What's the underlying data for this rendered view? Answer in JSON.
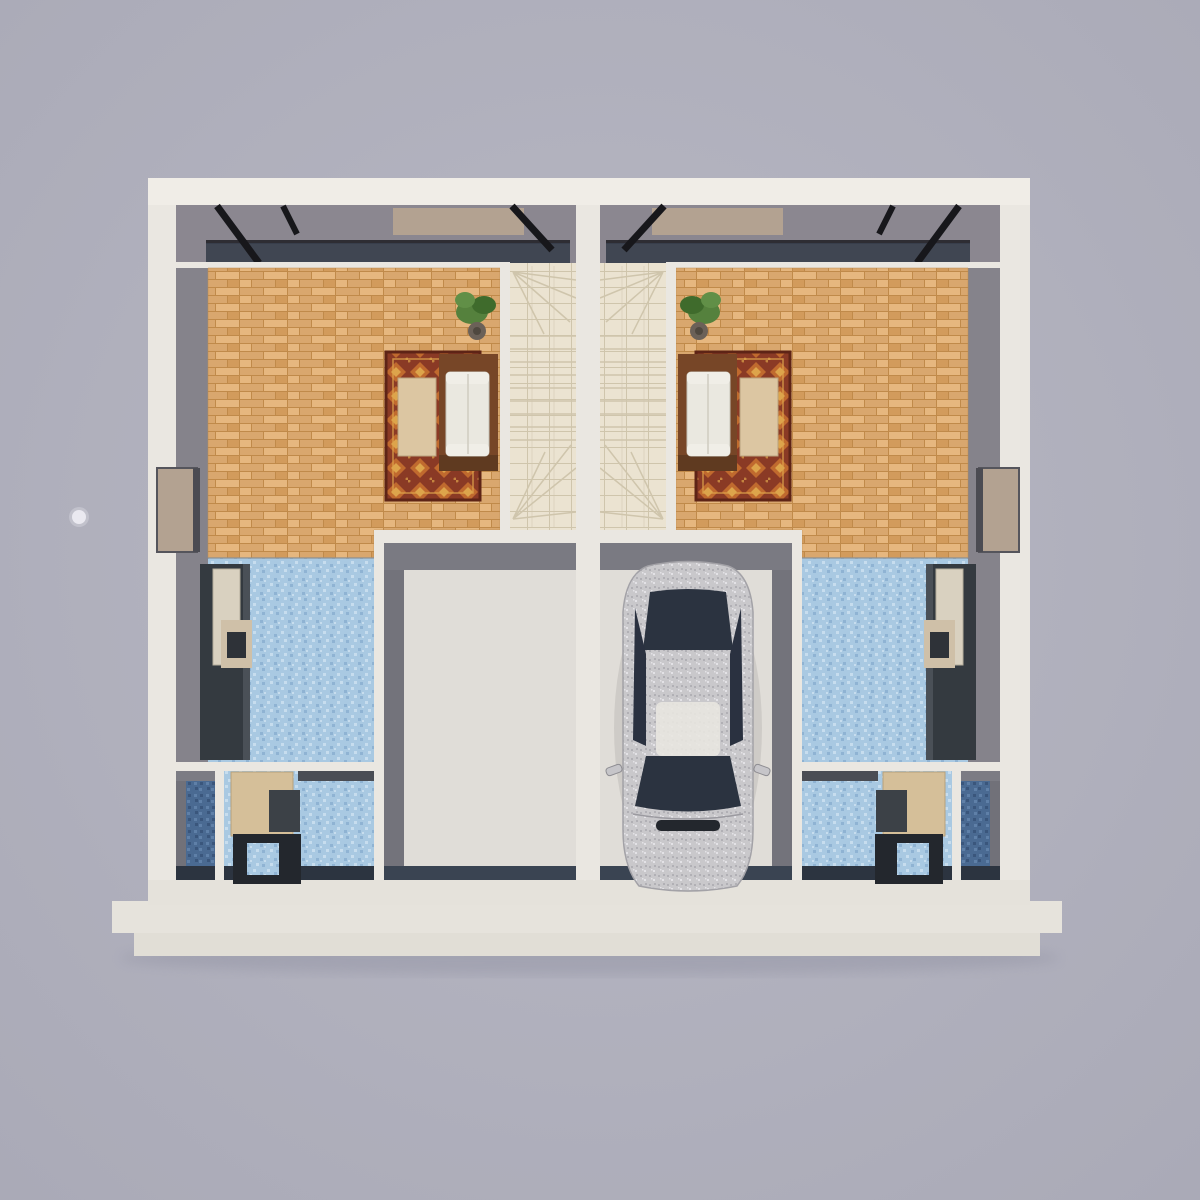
{
  "scene": {
    "type": "3d-floor-plan-render",
    "view": "top-down",
    "description": "Architectural 3D top-down render of a mirrored two-unit duplex ground floor. Each unit has a parquet living room with an oriental rug, a white sofa on a wood platform, a coffee table and a potted plant, a central staircase with winder steps, a garage, a blue-mosaic kitchen with refrigerator and cabinets, a study with a desk, and a dark-blue mosaic bathroom. A silver sedan is parked in the right unit's garage; the left garage is empty. A small round light dot floats on the background at the left.",
    "units": [
      {
        "name": "left-unit",
        "garage_contents": "empty"
      },
      {
        "name": "right-unit",
        "garage_contents": "silver-sedan"
      }
    ],
    "rooms_per_unit": [
      "living-room",
      "staircase",
      "garage",
      "kitchen",
      "study",
      "bathroom"
    ],
    "objects": [
      "building-shell",
      "foundation-slabs",
      "party-wall",
      "north-glazing",
      "side-windows",
      "area-rugs",
      "sofas",
      "coffee-tables",
      "potted-plants",
      "staircases",
      "refrigerators",
      "kitchen-cabinets",
      "desks",
      "car",
      "light-dot"
    ]
  },
  "colors": {
    "bg_center": "#b8b8c4",
    "bg_edge": "#a9a9b6",
    "wall": "#eae7e1",
    "wall_top": "#f0ede7",
    "wall_bottom": "#e5e2db",
    "slab": "#e6e3dc",
    "slab2": "#e1ded6",
    "north_wall_face": "#8b8790",
    "inner_wall_face": "#85838b",
    "glass": "#39404d",
    "frame_black": "#17171b",
    "paving_tan": "#b3a291",
    "parquet_base": "#d9a76e",
    "parquet_light": "#e6b77f",
    "parquet_mid": "#d29b5c",
    "parquet_dark": "#c08a4a",
    "stair_tile": "#ebe3d1",
    "stair_line": "#cfc5ac",
    "rug_base": "#8a3a25",
    "rug_accent": "#c06a2e",
    "rug_gold": "#dda44b",
    "rug_border": "#5e2416",
    "sofa_fabric": "#eae8e0",
    "sofa_frame": "#774627",
    "table_wood": "#dcc6a2",
    "plant_green": "#55813d",
    "plant_green_dark": "#3f6b2c",
    "plant_green_light": "#618f47",
    "plant_pot": "#6b6158",
    "kitchen_tile": "#a9c9e2",
    "kitchen_tile_light": "#c7ddee",
    "kitchen_tile_dark": "#8fb3d3",
    "bath_tile": "#4a6a92",
    "bath_tile_light": "#5f80a8",
    "bath_tile_dark": "#3a567c",
    "garage_floor": "#e0ddd8",
    "garage_face": "#73737b",
    "garage_face_top": "#7a7a82",
    "garage_door": "#3a4452",
    "cabinet_dark": "#343a40",
    "cabinet_cream": "#d9d1c0",
    "cabinet_beige": "#cfc0a8",
    "counter_gray": "#4a4d54",
    "desk_wood": "#d5bf99",
    "desk_dark": "#23272d",
    "appliance_dark": "#3c4147",
    "dark_strip": "#2c3440",
    "car_body": "#c9c8cb",
    "car_body_fleck_dark": "#b1b0b5",
    "car_body_fleck_light": "#e3e2e6",
    "car_glass": "#2b3340",
    "car_grille": "#23272d",
    "car_trim": "#a3a2a7",
    "dot": "#ecebf1"
  }
}
